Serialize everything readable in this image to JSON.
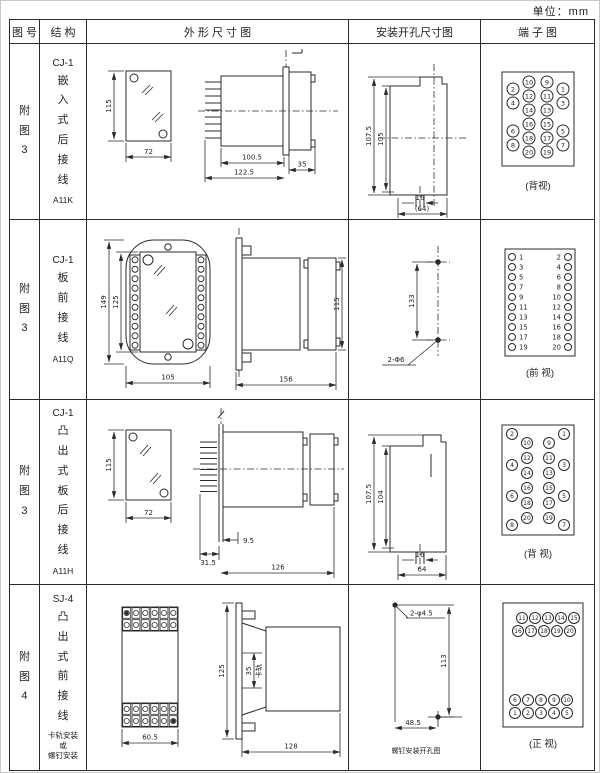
{
  "unit_label": "单位：mm",
  "header": {
    "col_fig": "图 号",
    "col_struct": "结 构",
    "col_outline": "外 形 尺 寸 图",
    "col_install": "安装开孔尺寸图",
    "col_terminal": "端 子 图"
  },
  "rows": [
    {
      "fig": "附图3",
      "model": "CJ-1",
      "struct": "嵌入式后接线",
      "code": "A11K",
      "outline": {
        "d_height": "115",
        "d_width": "72",
        "d1": "100.5",
        "d2": "122.5",
        "d3": "35"
      },
      "install": {
        "v1": "107.5",
        "v2": "105",
        "w1": "16",
        "w2": "(64)"
      },
      "terminal_view": "(背视)"
    },
    {
      "fig": "附图3",
      "model": "CJ-1",
      "struct": "板前接线",
      "code": "A11Q",
      "outline": {
        "d_height": "149",
        "d_height2": "125",
        "d_width": "105",
        "d_len": "156",
        "d_h3": "115"
      },
      "install": {
        "v1": "133",
        "hole": "2-Φ6"
      },
      "terminal_view": "(前 视)"
    },
    {
      "fig": "附图3",
      "model": "CJ-1",
      "struct": "凸出式板后接线",
      "code": "A11H",
      "outline": {
        "d_height": "115",
        "d_width": "72",
        "d1": "31.5",
        "d2": "9.5",
        "d3": "126"
      },
      "install": {
        "v1": "107.5",
        "v2": "104",
        "w1": "16",
        "w2": "64"
      },
      "terminal_view": "(背 视)"
    },
    {
      "fig": "附图4",
      "model": "SJ-4",
      "struct": "凸出式前接线",
      "note_lines": [
        "卡轨安装",
        "或",
        "螺钉安装"
      ],
      "outline": {
        "d_width": "60.5",
        "d_h": "125",
        "d_rail": "35",
        "rail_label": "卡轨",
        "d_len": "128"
      },
      "install": {
        "hole": "2-φ4.5",
        "v": "113",
        "h": "48.5",
        "caption": "螺钉安装开孔图"
      },
      "terminal_view": "(正 视)"
    }
  ],
  "terminals": {
    "t1": {
      "r": 6,
      "fs": 6.5,
      "items": [
        {
          "n": "10",
          "cx": 48,
          "cy": 20
        },
        {
          "n": "9",
          "cx": 66,
          "cy": 20
        },
        {
          "n": "2",
          "cx": 32,
          "cy": 27
        },
        {
          "n": "1",
          "cx": 82,
          "cy": 27
        },
        {
          "n": "12",
          "cx": 48,
          "cy": 34
        },
        {
          "n": "11",
          "cx": 66,
          "cy": 34
        },
        {
          "n": "4",
          "cx": 32,
          "cy": 41
        },
        {
          "n": "3",
          "cx": 82,
          "cy": 41
        },
        {
          "n": "14",
          "cx": 48,
          "cy": 48
        },
        {
          "n": "13",
          "cx": 66,
          "cy": 48
        },
        {
          "n": "16",
          "cx": 48,
          "cy": 62
        },
        {
          "n": "15",
          "cx": 66,
          "cy": 62
        },
        {
          "n": "6",
          "cx": 32,
          "cy": 69
        },
        {
          "n": "5",
          "cx": 82,
          "cy": 69
        },
        {
          "n": "18",
          "cx": 48,
          "cy": 76
        },
        {
          "n": "17",
          "cx": 66,
          "cy": 76
        },
        {
          "n": "8",
          "cx": 32,
          "cy": 83
        },
        {
          "n": "7",
          "cx": 82,
          "cy": 83
        },
        {
          "n": "20",
          "cx": 48,
          "cy": 90
        },
        {
          "n": "19",
          "cx": 66,
          "cy": 90
        }
      ]
    },
    "t2": {
      "r": 3.5,
      "fs": 6.8,
      "items": [
        {
          "n": "1",
          "cx": 31,
          "cy": 22,
          "tx": 38,
          "ty": 22,
          "a": "start"
        },
        {
          "n": "2",
          "cx": 87,
          "cy": 22,
          "tx": 80,
          "ty": 22,
          "a": "end"
        },
        {
          "n": "3",
          "cx": 31,
          "cy": 32,
          "tx": 38,
          "ty": 32,
          "a": "start"
        },
        {
          "n": "4",
          "cx": 87,
          "cy": 32,
          "tx": 80,
          "ty": 32,
          "a": "end"
        },
        {
          "n": "5",
          "cx": 31,
          "cy": 42,
          "tx": 38,
          "ty": 42,
          "a": "start"
        },
        {
          "n": "6",
          "cx": 87,
          "cy": 42,
          "tx": 80,
          "ty": 42,
          "a": "end"
        },
        {
          "n": "7",
          "cx": 31,
          "cy": 52,
          "tx": 38,
          "ty": 52,
          "a": "start"
        },
        {
          "n": "8",
          "cx": 87,
          "cy": 52,
          "tx": 80,
          "ty": 52,
          "a": "end"
        },
        {
          "n": "9",
          "cx": 31,
          "cy": 62,
          "tx": 38,
          "ty": 62,
          "a": "start"
        },
        {
          "n": "10",
          "cx": 87,
          "cy": 62,
          "tx": 80,
          "ty": 62,
          "a": "end"
        },
        {
          "n": "11",
          "cx": 31,
          "cy": 72,
          "tx": 38,
          "ty": 72,
          "a": "start"
        },
        {
          "n": "12",
          "cx": 87,
          "cy": 72,
          "tx": 80,
          "ty": 72,
          "a": "end"
        },
        {
          "n": "13",
          "cx": 31,
          "cy": 82,
          "tx": 38,
          "ty": 82,
          "a": "start"
        },
        {
          "n": "14",
          "cx": 87,
          "cy": 82,
          "tx": 80,
          "ty": 82,
          "a": "end"
        },
        {
          "n": "15",
          "cx": 31,
          "cy": 92,
          "tx": 38,
          "ty": 92,
          "a": "start"
        },
        {
          "n": "16",
          "cx": 87,
          "cy": 92,
          "tx": 80,
          "ty": 92,
          "a": "end"
        },
        {
          "n": "17",
          "cx": 31,
          "cy": 102,
          "tx": 38,
          "ty": 102,
          "a": "start"
        },
        {
          "n": "18",
          "cx": 87,
          "cy": 102,
          "tx": 80,
          "ty": 102,
          "a": "end"
        },
        {
          "n": "19",
          "cx": 31,
          "cy": 112,
          "tx": 38,
          "ty": 112,
          "a": "start"
        },
        {
          "n": "20",
          "cx": 87,
          "cy": 112,
          "tx": 80,
          "ty": 112,
          "a": "end"
        }
      ]
    },
    "t3": {
      "r": 5.5,
      "fs": 6,
      "items": [
        {
          "n": "2",
          "cx": 31,
          "cy": 17
        },
        {
          "n": "1",
          "cx": 83,
          "cy": 17
        },
        {
          "n": "10",
          "cx": 46,
          "cy": 26
        },
        {
          "n": "9",
          "cx": 68,
          "cy": 26
        },
        {
          "n": "12",
          "cx": 46,
          "cy": 41
        },
        {
          "n": "11",
          "cx": 68,
          "cy": 41
        },
        {
          "n": "4",
          "cx": 31,
          "cy": 48
        },
        {
          "n": "3",
          "cx": 83,
          "cy": 48
        },
        {
          "n": "14",
          "cx": 46,
          "cy": 56
        },
        {
          "n": "13",
          "cx": 68,
          "cy": 56
        },
        {
          "n": "16",
          "cx": 46,
          "cy": 71
        },
        {
          "n": "15",
          "cx": 68,
          "cy": 71
        },
        {
          "n": "6",
          "cx": 31,
          "cy": 79
        },
        {
          "n": "5",
          "cx": 83,
          "cy": 79
        },
        {
          "n": "18",
          "cx": 46,
          "cy": 86
        },
        {
          "n": "17",
          "cx": 68,
          "cy": 86
        },
        {
          "n": "20",
          "cx": 46,
          "cy": 101
        },
        {
          "n": "19",
          "cx": 68,
          "cy": 101
        },
        {
          "n": "8",
          "cx": 31,
          "cy": 108
        },
        {
          "n": "7",
          "cx": 83,
          "cy": 108
        }
      ]
    },
    "t4": {
      "r": 5.5,
      "fs": 5.8,
      "items": [
        {
          "n": "11",
          "cx": 41,
          "cy": 23
        },
        {
          "n": "12",
          "cx": 54,
          "cy": 23
        },
        {
          "n": "13",
          "cx": 67,
          "cy": 23
        },
        {
          "n": "14",
          "cx": 80,
          "cy": 23
        },
        {
          "n": "15",
          "cx": 93,
          "cy": 23
        },
        {
          "n": "16",
          "cx": 37,
          "cy": 36
        },
        {
          "n": "17",
          "cx": 50,
          "cy": 36
        },
        {
          "n": "18",
          "cx": 63,
          "cy": 36
        },
        {
          "n": "19",
          "cx": 76,
          "cy": 36
        },
        {
          "n": "20",
          "cx": 89,
          "cy": 36
        },
        {
          "n": "6",
          "cx": 34,
          "cy": 105
        },
        {
          "n": "7",
          "cx": 47,
          "cy": 105
        },
        {
          "n": "8",
          "cx": 60,
          "cy": 105
        },
        {
          "n": "9",
          "cx": 73,
          "cy": 105
        },
        {
          "n": "10",
          "cx": 86,
          "cy": 105
        },
        {
          "n": "1",
          "cx": 34,
          "cy": 118
        },
        {
          "n": "2",
          "cx": 47,
          "cy": 118
        },
        {
          "n": "3",
          "cx": 60,
          "cy": 118
        },
        {
          "n": "4",
          "cx": 73,
          "cy": 118
        },
        {
          "n": "5",
          "cx": 86,
          "cy": 118
        }
      ]
    }
  }
}
